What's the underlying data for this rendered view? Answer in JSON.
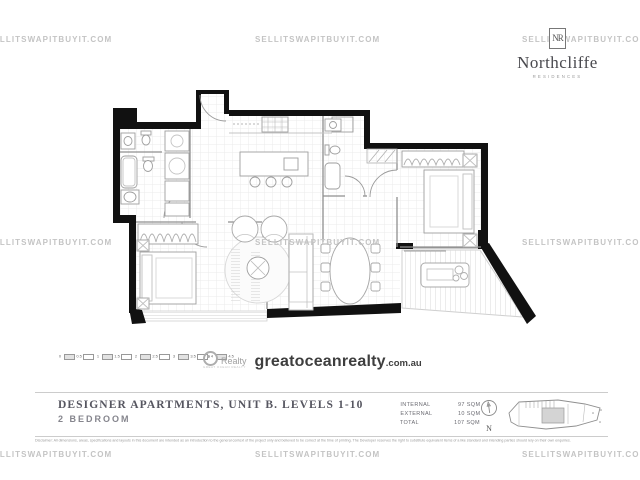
{
  "watermark": {
    "text": "SELLITSWAPITBUYIT.COM"
  },
  "brand": {
    "monogram": "NR",
    "name": "Northcliffe",
    "tagline": "RESIDENCES"
  },
  "agency": {
    "icon_label": "Realty",
    "icon_sub": "GREAT OCEAN REALTY",
    "domain": "greatoceanrealty",
    "tld": ".com.au"
  },
  "scale_bar": {
    "labels": [
      "0",
      "0.5",
      "1",
      "1.5",
      "2",
      "2.5",
      "3",
      "3.5",
      "4",
      "4.5"
    ]
  },
  "title_block": {
    "title": "DESIGNER APARTMENTS, UNIT B. LEVELS 1-10",
    "subtitle": "2 BEDROOM",
    "areas": [
      {
        "label": "INTERNAL",
        "value": "97 SQM"
      },
      {
        "label": "EXTERNAL",
        "value": "10 SQM"
      },
      {
        "label": "TOTAL",
        "value": "107 SQM"
      }
    ],
    "north_label": "N",
    "disclaimer": "Disclaimer: All dimensions, areas, specifications and layouts in this document are intended as an introduction to the general context of the project only and believed to be correct at the time of printing. The Developer reserves the right to substitute equivalent items of a like standard and intending parties should rely on their own enquiries."
  },
  "colors": {
    "wall": "#111111",
    "watermark": "#c4c4c4",
    "accent_text": "#565660"
  }
}
